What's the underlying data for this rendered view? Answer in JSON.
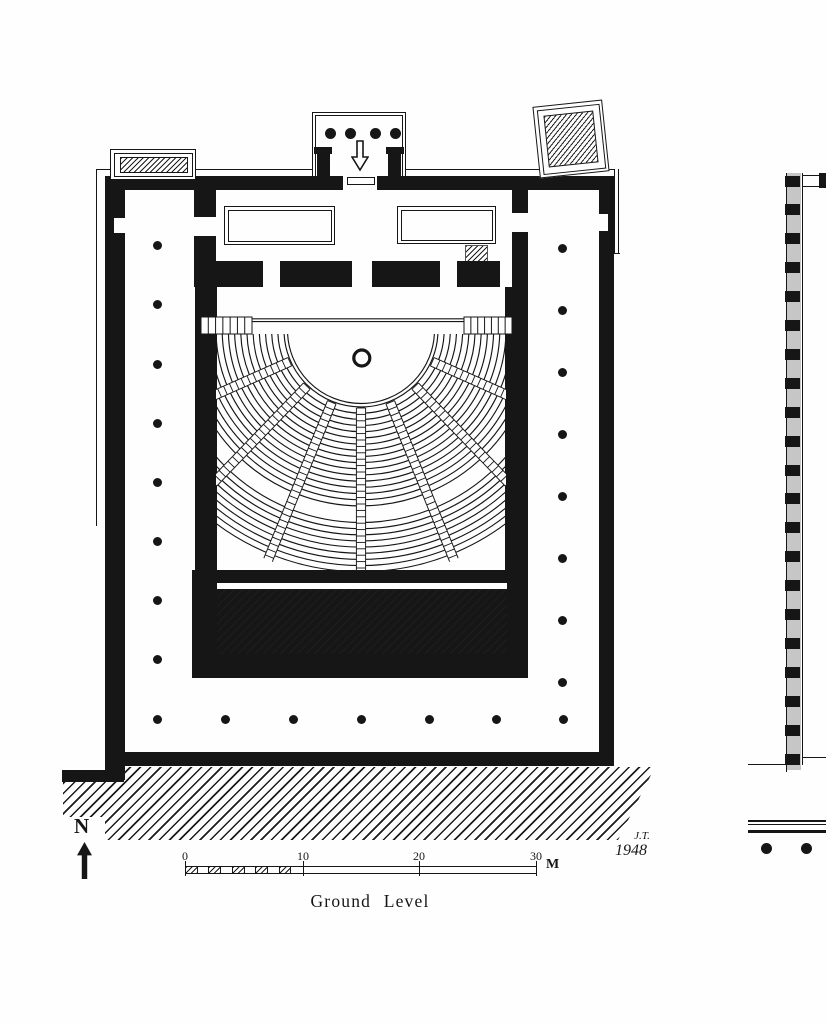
{
  "title_caption": "Ground Level",
  "north": {
    "label": "N"
  },
  "scale_bar": {
    "ticks": [
      "0",
      "10",
      "20",
      "30"
    ],
    "unit_label": "M"
  },
  "signature": {
    "initials": "J.T.",
    "year": "1948"
  },
  "colors": {
    "ink": "#161616",
    "paper": "#fefefe"
  }
}
